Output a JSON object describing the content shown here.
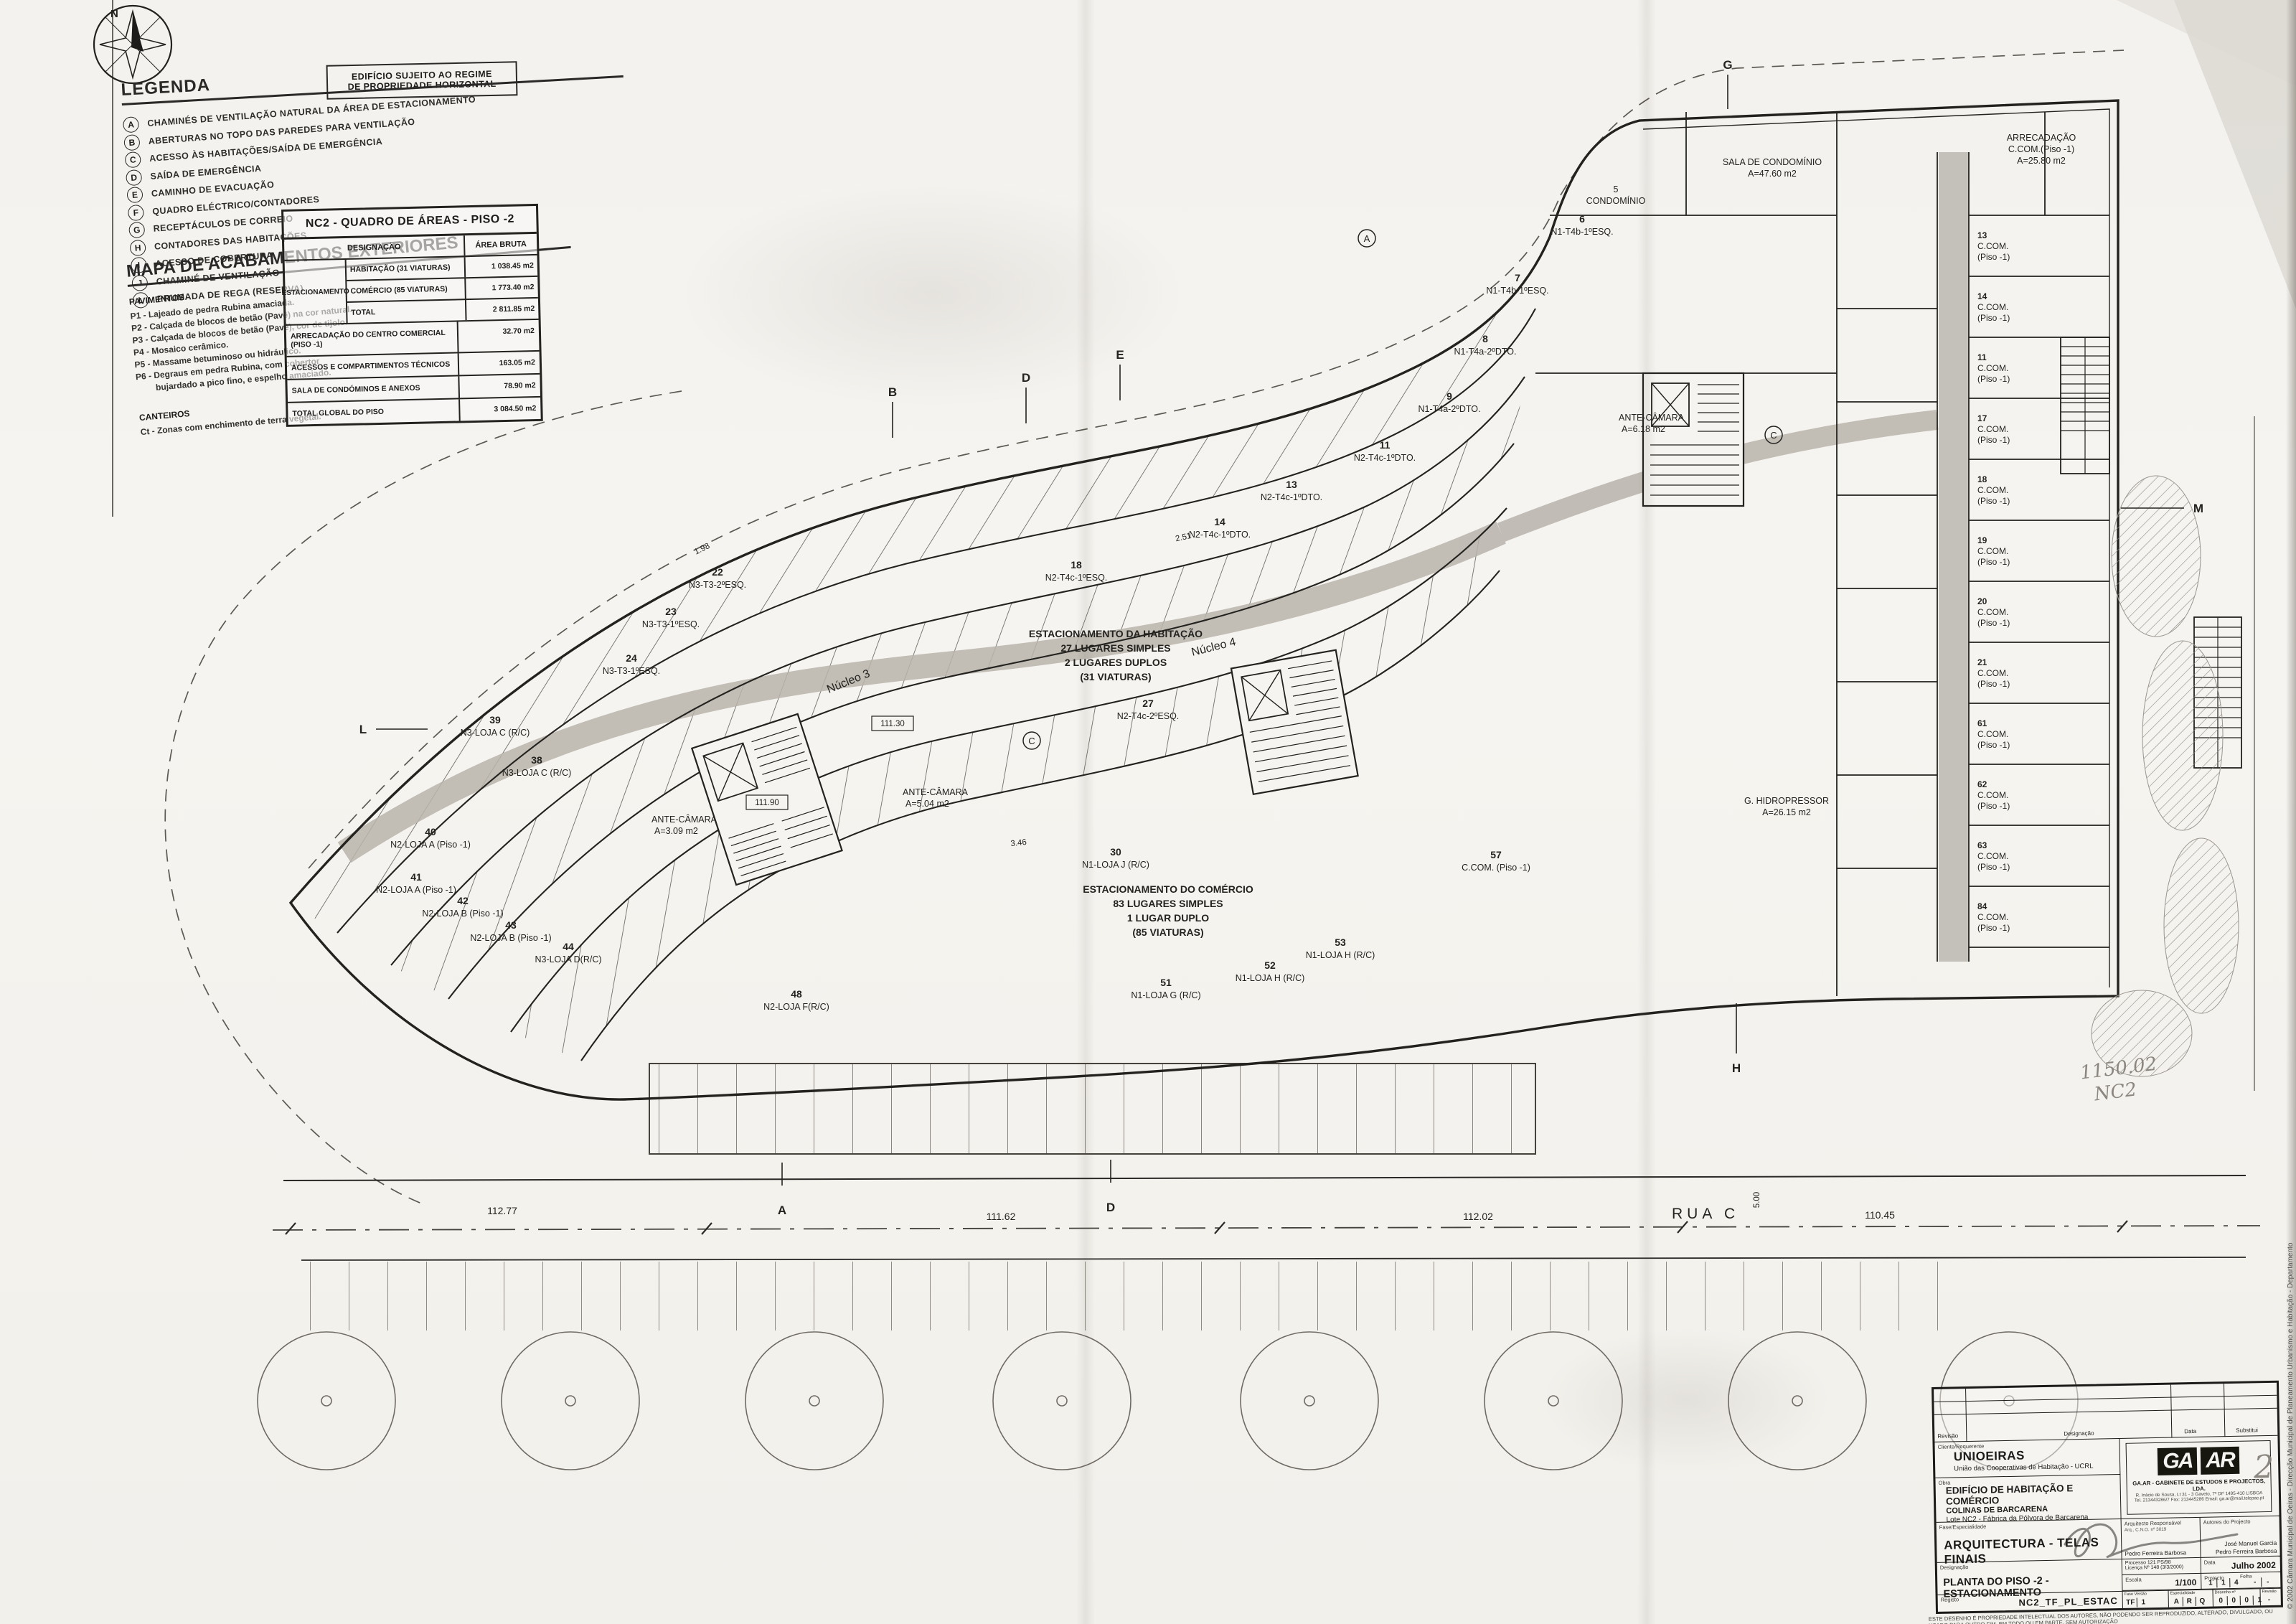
{
  "sheet": {
    "north_letter": "N",
    "regime_box": {
      "line1": "EDIFÍCIO SUJEITO AO REGIME",
      "line2": "DE PROPRIEDADE HORIZONTAL"
    }
  },
  "legend": {
    "title": "LEGENDA",
    "items": [
      {
        "key": "A",
        "label": "CHAMINÉS DE VENTILAÇÃO NATURAL DA ÁREA DE ESTACIONAMENTO"
      },
      {
        "key": "B",
        "label": "ABERTURAS NO TOPO DAS PAREDES PARA VENTILAÇÃO"
      },
      {
        "key": "C",
        "label": "ACESSO ÀS HABITAÇÕES/SAÍDA DE EMERGÊNCIA"
      },
      {
        "key": "D",
        "label": "SAÍDA DE EMERGÊNCIA"
      },
      {
        "key": "E",
        "label": "CAMINHO DE EVACUAÇÃO"
      },
      {
        "key": "F",
        "label": "QUADRO ELÉCTRICO/CONTADORES"
      },
      {
        "key": "G",
        "label": "RECEPTÁCULOS DE CORREIO"
      },
      {
        "key": "H",
        "label": "CONTADORES DAS HABITAÇÕES"
      },
      {
        "key": "I",
        "label": "ACESSO DE COBERTURA"
      },
      {
        "key": "J",
        "label": "CHAMINÉ DE VENTILAÇÃO"
      },
      {
        "key": "L",
        "label": "PRUMADA DE REGA (RESERVA)"
      }
    ]
  },
  "finishes": {
    "title": "MAPA DE ACABAMENTOS EXTERIORES",
    "pav_label": "PAVIMENTOS",
    "pav_items": [
      "P1 - Lajeado de pedra Rubina amaciada.",
      "P2 - Calçada de blocos de betão (Pavê) na cor natural.",
      "P3 - Calçada de blocos de betão (Pavê), cor de tijolo.",
      "P4 - Mosaico cerâmico.",
      "P5 - Massame betuminoso ou hidráulico.",
      "P6 - Degraus em pedra Rubina, com cobertor",
      "        bujardado a pico fino, e espelho amaciado."
    ],
    "cant_label": "CANTEIROS",
    "cant_item": "Ct - Zonas com enchimento de terra vegetal."
  },
  "areas_table": {
    "title": "NC2 - QUADRO DE ÁREAS - PISO -2",
    "col_desig": "DESIGNAÇÃO",
    "col_area": "ÁREA BRUTA",
    "group_label": "ESTACIONAMENTO",
    "grouped_rows": [
      {
        "d": "HABITAÇÃO (31 VIATURAS)",
        "a": "1 038.45 m2"
      },
      {
        "d": "COMÉRCIO (85 VIATURAS)",
        "a": "1 773.40 m2"
      },
      {
        "d": "TOTAL",
        "a": "2 811.85 m2"
      }
    ],
    "rows": [
      {
        "d": "ARRECADAÇÃO DO CENTRO COMERCIAL (PISO -1)",
        "a": "32.70 m2"
      },
      {
        "d": "ACESSOS E COMPARTIMENTOS TÉCNICOS",
        "a": "163.05 m2"
      },
      {
        "d": "SALA DE CONDÓMINOS E ANEXOS",
        "a": "78.90 m2"
      },
      {
        "d": "TOTAL GLOBAL DO PISO",
        "a": "3 084.50 m2"
      }
    ]
  },
  "plan": {
    "notes": {
      "parking_hab_1": "ESTACIONAMENTO DA HABITAÇÃO",
      "parking_hab_2": "27 LUGARES SIMPLES",
      "parking_hab_3": "2 LUGARES DUPLOS",
      "parking_hab_4": "(31 VIATURAS)",
      "parking_com_1": "ESTACIONAMENTO DO COMÉRCIO",
      "parking_com_2": "83 LUGARES SIMPLES",
      "parking_com_3": "1 LUGAR DUPLO",
      "parking_com_4": "(85 VIATURAS)",
      "rua": "RUA C",
      "nucleo3": "Núcleo 3",
      "nucleo4": "Núcleo 4",
      "ante1_t": "ANTE-CÂMARA",
      "ante1_a": "A=5.04 m2",
      "ante2_t": "ANTE-CÂMARA",
      "ante2_a": "A=3.09 m2",
      "ante3_t": "ANTE-CÂMARA",
      "ante3_a": "A=6.18 m2",
      "sala_t": "SALA DE CONDOMÍNIO",
      "sala_a": "A=47.60 m2",
      "cond_n": "5",
      "cond_t": "CONDOMÍNIO",
      "arrec_t": "ARRECADAÇÃO",
      "arrec_s": "C.COM.(Piso -1)",
      "arrec_a": "A=25.80 m2",
      "hidro_t": "G. HIDROPRESSOR",
      "hidro_a": "A=26.15 m2"
    },
    "grid_markers": [
      "G",
      "B",
      "D",
      "E",
      "L",
      "M",
      "A",
      "D",
      "H"
    ],
    "circled": [
      "A",
      "C",
      "C"
    ],
    "dims": [
      "112.77",
      "111.62",
      "112.02",
      "110.45",
      "111.30",
      "111.90",
      "5.00",
      "2.51",
      "3.46",
      "1.98"
    ],
    "stalls": [
      {
        "n": "6",
        "t": "N1-T4b-1ºESQ."
      },
      {
        "n": "7",
        "t": "N1-T4b-1ºESQ."
      },
      {
        "n": "8",
        "t": "N1-T4a-2ºDTO."
      },
      {
        "n": "9",
        "t": "N1-T4a-2ºDTO."
      },
      {
        "n": "11",
        "t": "N2-T4c-1ºDTO."
      },
      {
        "n": "13",
        "t": "N2-T4c-1ºDTO."
      },
      {
        "n": "14",
        "t": "N2-T4c-1ºDTO."
      },
      {
        "n": "18",
        "t": "N2-T4c-1ºESQ."
      },
      {
        "n": "22",
        "t": "N3-T3-2ºESQ."
      },
      {
        "n": "23",
        "t": "N3-T3-1ºESQ."
      },
      {
        "n": "24",
        "t": "N3-T3-1ºESQ."
      },
      {
        "n": "27",
        "t": "N2-T4c-2ºESQ."
      },
      {
        "n": "39",
        "t": "N3-LOJA C (R/C)"
      },
      {
        "n": "38",
        "t": "N3-LOJA C (R/C)"
      },
      {
        "n": "40",
        "t": "N2-LOJA A (Piso -1)"
      },
      {
        "n": "41",
        "t": "N2-LOJA A (Piso -1)"
      },
      {
        "n": "42",
        "t": "N2-LOJA B (Piso -1)"
      },
      {
        "n": "43",
        "t": "N2-LOJA B (Piso -1)"
      },
      {
        "n": "44",
        "t": "N3-LOJA D(R/C)"
      },
      {
        "n": "48",
        "t": "N2-LOJA F(R/C)"
      },
      {
        "n": "51",
        "t": "N1-LOJA G (R/C)"
      },
      {
        "n": "52",
        "t": "N1-LOJA H (R/C)"
      },
      {
        "n": "53",
        "t": "N1-LOJA H (R/C)"
      },
      {
        "n": "30",
        "t": "N1-LOJA J (R/C)"
      },
      {
        "n": "57",
        "t": "C.COM. (Piso -1)"
      }
    ],
    "cells": [
      {
        "n": "13",
        "t": "C.COM.",
        "s": "(Piso -1)"
      },
      {
        "n": "14",
        "t": "C.COM.",
        "s": "(Piso -1)"
      },
      {
        "n": "11",
        "t": "C.COM.",
        "s": "(Piso -1)"
      },
      {
        "n": "17",
        "t": "C.COM.",
        "s": "(Piso -1)"
      },
      {
        "n": "18",
        "t": "C.COM.",
        "s": "(Piso -1)"
      },
      {
        "n": "19",
        "t": "C.COM.",
        "s": "(Piso -1)"
      },
      {
        "n": "20",
        "t": "C.COM.",
        "s": "(Piso -1)"
      },
      {
        "n": "21",
        "t": "C.COM.",
        "s": "(Piso -1)"
      },
      {
        "n": "61",
        "t": "C.COM.",
        "s": "(Piso -1)"
      },
      {
        "n": "62",
        "t": "C.COM.",
        "s": "(Piso -1)"
      },
      {
        "n": "63",
        "t": "C.COM.",
        "s": "(Piso -1)"
      },
      {
        "n": "84",
        "t": "C.COM.",
        "s": "(Piso -1)"
      }
    ]
  },
  "titleblock": {
    "rev_header": {
      "revisao": "Revisão",
      "designacao": "Designação",
      "data": "Data",
      "substitui": "Substitui"
    },
    "client_label": "Cliente/Requerente",
    "client_name": "UNIOEIRAS",
    "client_sub": "União das Cooperativas de Habitação - UCRL",
    "obra_label": "Obra",
    "obra_1": "EDIFÍCIO DE HABITAÇÃO E COMÉRCIO",
    "obra_2": "COLINAS DE BARCARENA",
    "obra_3": "Lote NC2 - Fábrica da Pólvora de Barcarena",
    "office_name": "GA.AR - GABINETE DE ESTUDOS E PROJECTOS, LDA.",
    "office_line2": "R. Inácio de Sousa, Lt 31 - 3 Gaveto, 7º Dtº  1495-410 LISBOA",
    "office_line3": "Tel. 213443286/7  Fax: 213445286   Email: ga.ar@mail.telepac.pt",
    "logo_a": "GA",
    "logo_b": "AR",
    "fase_label": "Fase/Especialidade",
    "fase": "ARQUITECTURA - TELAS FINAIS",
    "arch_label": "Arquitecto Responsável",
    "arch_sub": "Arq., C.N.O. nº 3019",
    "arch_name": "Pedro Ferreira Barbosa",
    "authors_label": "Autores do Projecto",
    "author_1": "José Manuel Garcia",
    "author_2": "Pedro Ferreira Barbosa",
    "processo": "Processo 121 PS/98",
    "licenca": "Licença Nº 148 (3/3/2000)",
    "data_label": "Data",
    "data": "Julho 2002",
    "desig_label": "Designação",
    "designacao": "PLANTA DO PISO -2 - ESTACIONAMENTO",
    "escala_label": "Escala",
    "escala": "1/100",
    "projecto_label": "Projecto",
    "projecto_boxes": [
      "1",
      "1",
      "4"
    ],
    "folha_label": "Folha",
    "folha_boxes": [
      "-",
      "-"
    ],
    "file_label": "Registo",
    "file_code": "NC2_TF_PL_ESTAC",
    "fase_v_label": "Fase  Versão",
    "fase_boxes": [
      "TF",
      "1"
    ],
    "espec_label": "Especialidade",
    "espec_boxes": [
      "A",
      "R",
      "Q"
    ],
    "desenho_label": "Desenho nº",
    "desenho_boxes": [
      "0",
      "0",
      "0",
      "1"
    ],
    "revisao_label": "Revisão",
    "revisao_box": "-",
    "disclaimer_1": "ESTE DESENHO É PROPRIEDADE INTELECTUAL DOS AUTORES, NÃO PODENDO SER REPRODUZIDO, ALTERADO, DIVULGADO, OU USADO PARA OUTRO FIM, EM TODO OU EM PARTE, SEM AUTORIZAÇÃO",
    "disclaimer_2": "EXPRESSA DOS MESMOS.  RESERVADOS TODOS OS DIREITOS DE ACORDO COM A LEGISLAÇÃO EM VIGOR."
  },
  "stamp": {
    "line1": "© 2002      Câmara Municipal de Oeiras - Direcção Municipal de Planeamento Urbanismo e Habitação - Departamento",
    "line2": "Este exemplar é cópia fiel do documento constante a folha 21 do Req/Reg nº 11893 2002, do Processo nº 520 1998, sito em",
    "line3": "Rua das Azenhas, Bl. 2A, 2B e 2C (Núcleo 2) — Fábrica da Pólvora de Barcarena — Freguesia de Barcarena — 1. LA"
  },
  "annotations": {
    "sheet_number": "2",
    "pencil_1": "1150.02",
    "pencil_2": "NC2"
  }
}
